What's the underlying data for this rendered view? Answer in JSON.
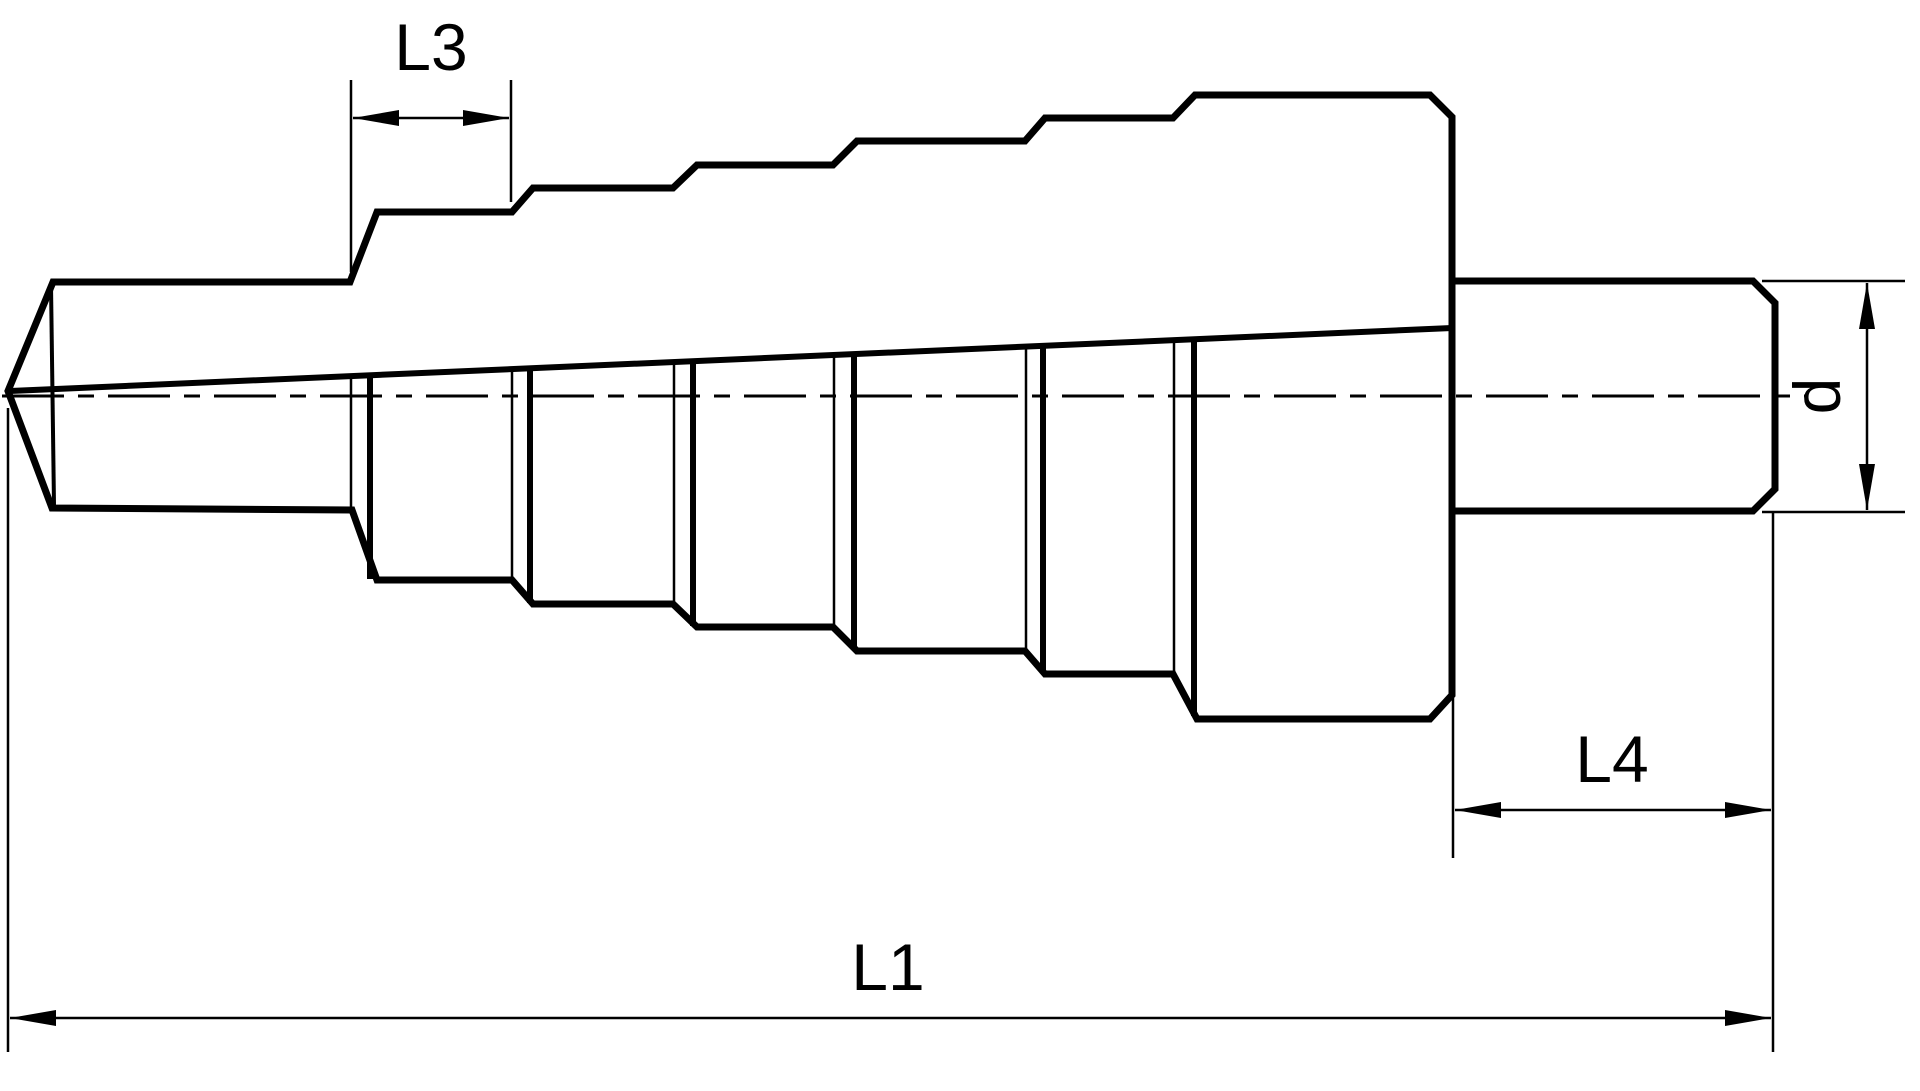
{
  "drawing": {
    "title": "step-drill-technical-drawing",
    "background_color": "#ffffff",
    "line_color": "#000000",
    "dimensions": {
      "step_length_label": "L3",
      "overall_length_label": "L1",
      "shank_length_label": "L4",
      "shank_diameter_label": "d"
    }
  }
}
